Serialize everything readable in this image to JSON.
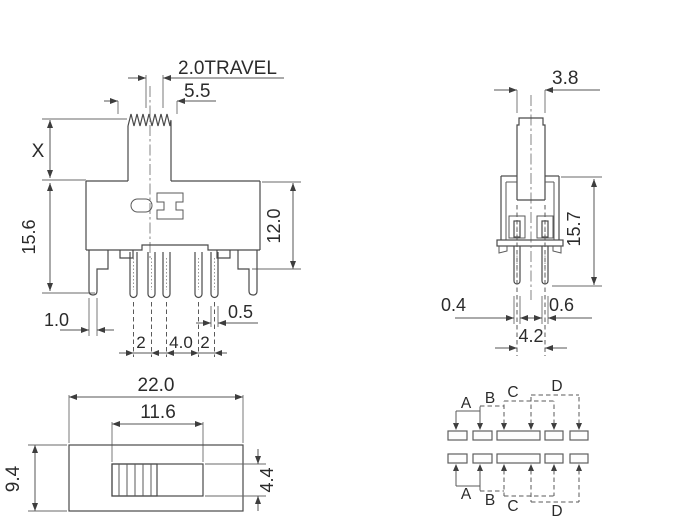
{
  "drawing_title": "slide-switch-dimension-drawing",
  "front_view": {
    "travel_label": "2.0TRAVEL",
    "knob_width": "5.5",
    "stem_height": "X",
    "total_height": "15.6",
    "body_height": "12.0",
    "bracket_leg_width": "1.0",
    "pin_width": "0.5",
    "pin_pitch_left": "2",
    "pin_pitch_center": "4.0",
    "pin_pitch_right": "2"
  },
  "side_view": {
    "knob_thickness": "3.8",
    "total_height": "15.7",
    "front_pin_width": "0.4",
    "rear_pin_width": "0.6",
    "pin_row_spacing": "4.2"
  },
  "top_view": {
    "body_length": "22.0",
    "slot_length": "11.6",
    "body_width": "9.4",
    "slot_width": "4.4"
  },
  "schematic": {
    "top_labels": [
      "A",
      "B",
      "C",
      "D"
    ],
    "bottom_labels": [
      "A",
      "B",
      "C",
      "D"
    ]
  },
  "colors": {
    "line": "#4a4a4a",
    "text": "#2b2b2b",
    "background": "#ffffff"
  }
}
